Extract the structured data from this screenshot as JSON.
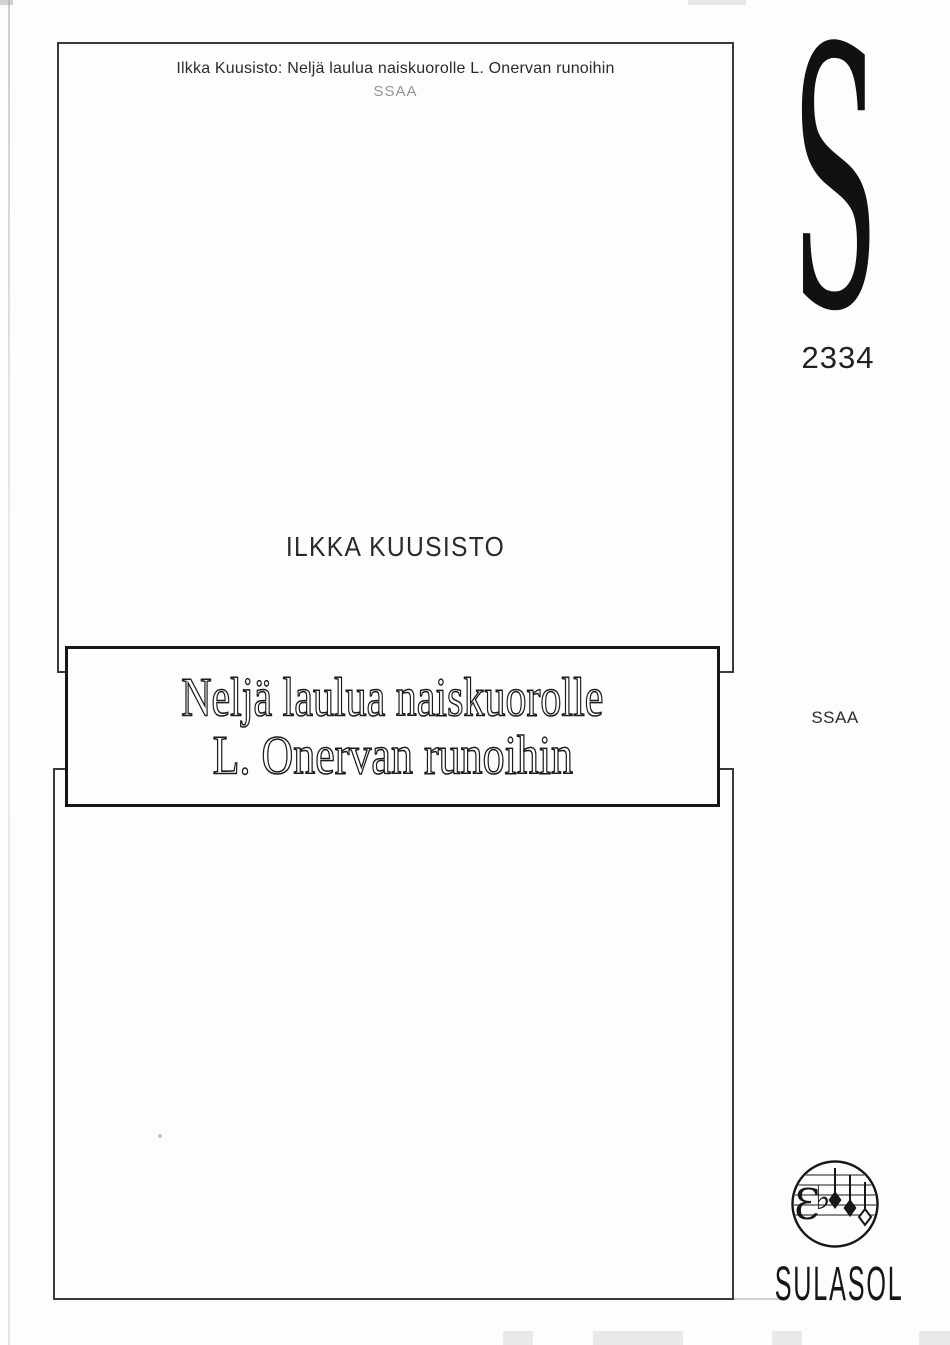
{
  "header": {
    "title": "Ilkka Kuusisto: Neljä laulua naiskuorolle L. Onervan runoihin",
    "voicing": "SSAA"
  },
  "composer": "ILKKA KUUSISTO",
  "title_box": {
    "line1": "Neljä laulua naiskuorolle",
    "line2": "L. Onervan runoihin"
  },
  "catalog": {
    "series_letter": "S",
    "number": "2334",
    "voicing": "SSAA"
  },
  "publisher": {
    "name": "SULASOL",
    "clef_glyph": "Ɛ",
    "flat_glyph": "♭"
  },
  "colors": {
    "ink": "#1f1f1f",
    "frame_border": "#3a3a3a",
    "title_border": "#161616",
    "muted_gray": "#949494",
    "paper": "#fdfdfc"
  }
}
